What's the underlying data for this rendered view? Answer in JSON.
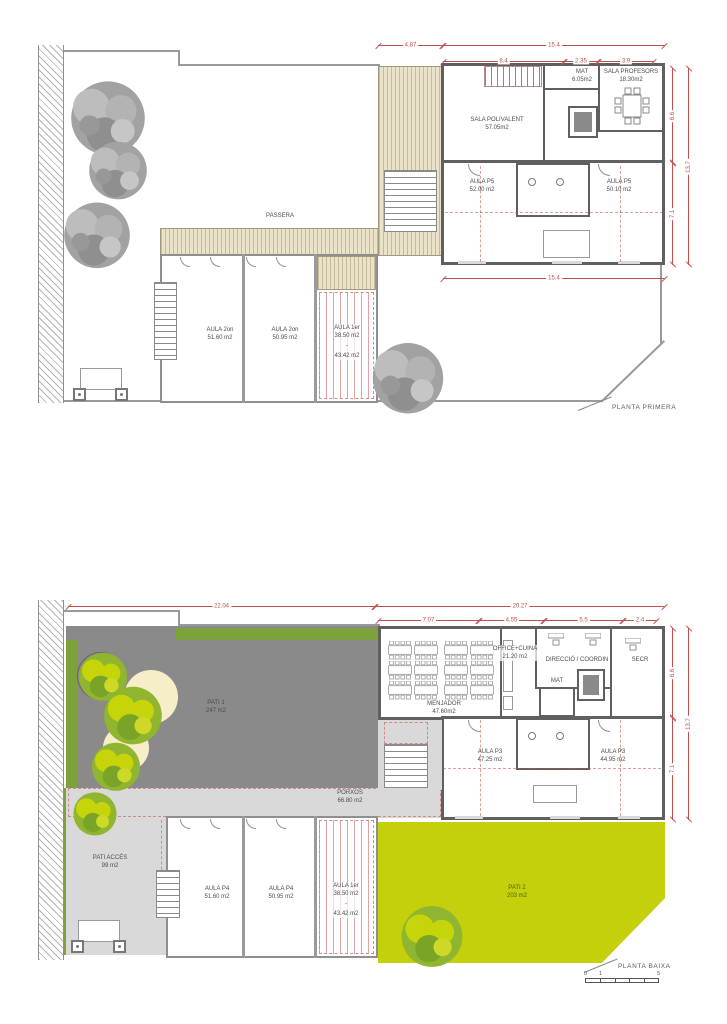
{
  "colors": {
    "dimension_red": "#c0504d",
    "wall_dark": "#606060",
    "pati1_gray": "#8a8a8a",
    "paving_light_gray": "#d9d9d9",
    "green_bright": "#c3d00b",
    "green_olive": "#7ea23b",
    "wood_deck": "#ebe3c9",
    "sand_cream": "#f5eec9",
    "tree_gray": "#a2a2a2"
  },
  "plan1": {
    "title": "PLANTA PRIMERA",
    "dims": {
      "d487": "4.87",
      "d154_top": "15.4",
      "d84": "8.4",
      "d235": "2.35",
      "d39": "3.9",
      "d66": "6.6",
      "d137": "13.7",
      "d71": "7.1",
      "d154_bottom": "15.4"
    },
    "rooms": {
      "passera": {
        "name": "PASSERA"
      },
      "sala_polivalent": {
        "name": "SALA POLIVALENT",
        "area": "57.05m2"
      },
      "mat": {
        "name": "MAT",
        "area": "6.05m2"
      },
      "professors": {
        "name": "SALA PROFESORS",
        "area": "18.30m2"
      },
      "aula_p5_a": {
        "name": "AULA P5",
        "area": "52.00 m2"
      },
      "aula_p5_b": {
        "name": "AULA P5",
        "area": "50.10 m2"
      },
      "aula_2on_a": {
        "name": "AULA 2on",
        "area": "51.60 m2"
      },
      "aula_2on_b": {
        "name": "AULA 2on",
        "area": "50.95 m2"
      },
      "aula_1er": {
        "name": "AULA 1er",
        "area_top": "38.50 m2",
        "dash": "-",
        "area_bottom": "43.42 m2"
      }
    }
  },
  "plan2": {
    "title": "PLANTA BAIXA",
    "dims": {
      "d2204": "22.04",
      "d2027": "20.27",
      "d707": "7.07",
      "d455": "4.55",
      "d55": "5.5",
      "d24": "2.4",
      "d66": "6.6",
      "d137": "13.7",
      "d71": "7.1"
    },
    "rooms": {
      "pati1": {
        "name": "PATI 1",
        "area": "247 m2"
      },
      "menjador": {
        "name": "MENJADOR",
        "area": "47.60m2"
      },
      "office": {
        "name": "OFFICE+CUINA",
        "area": "21.20 m2"
      },
      "direccio": {
        "name": "DIRECCIÓ / COORDIN"
      },
      "mat": {
        "name": "MAT"
      },
      "secr": {
        "name": "SECR"
      },
      "aula_p3_a": {
        "name": "AULA P3",
        "area": "47.25 m2"
      },
      "aula_p3_b": {
        "name": "AULA P3",
        "area": "44.95 m2"
      },
      "porxos": {
        "name": "PORXOS",
        "area": "66.80 m2"
      },
      "pati_acces": {
        "name": "PATI ACCÉS",
        "area": "99 m2"
      },
      "aula_p4_a": {
        "name": "AULA P4",
        "area": "51.60 m2"
      },
      "aula_p4_b": {
        "name": "AULA P4",
        "area": "50.95 m2"
      },
      "aula_1er": {
        "name": "AULA 1er",
        "area_top": "38.50 m2",
        "dash": "-",
        "area_bottom": "43.42 m2"
      },
      "pati2": {
        "name": "PATI 2",
        "area": "203 m2"
      }
    },
    "scalebar": {
      "s0": "0",
      "s1": "1",
      "s5": "5"
    }
  }
}
